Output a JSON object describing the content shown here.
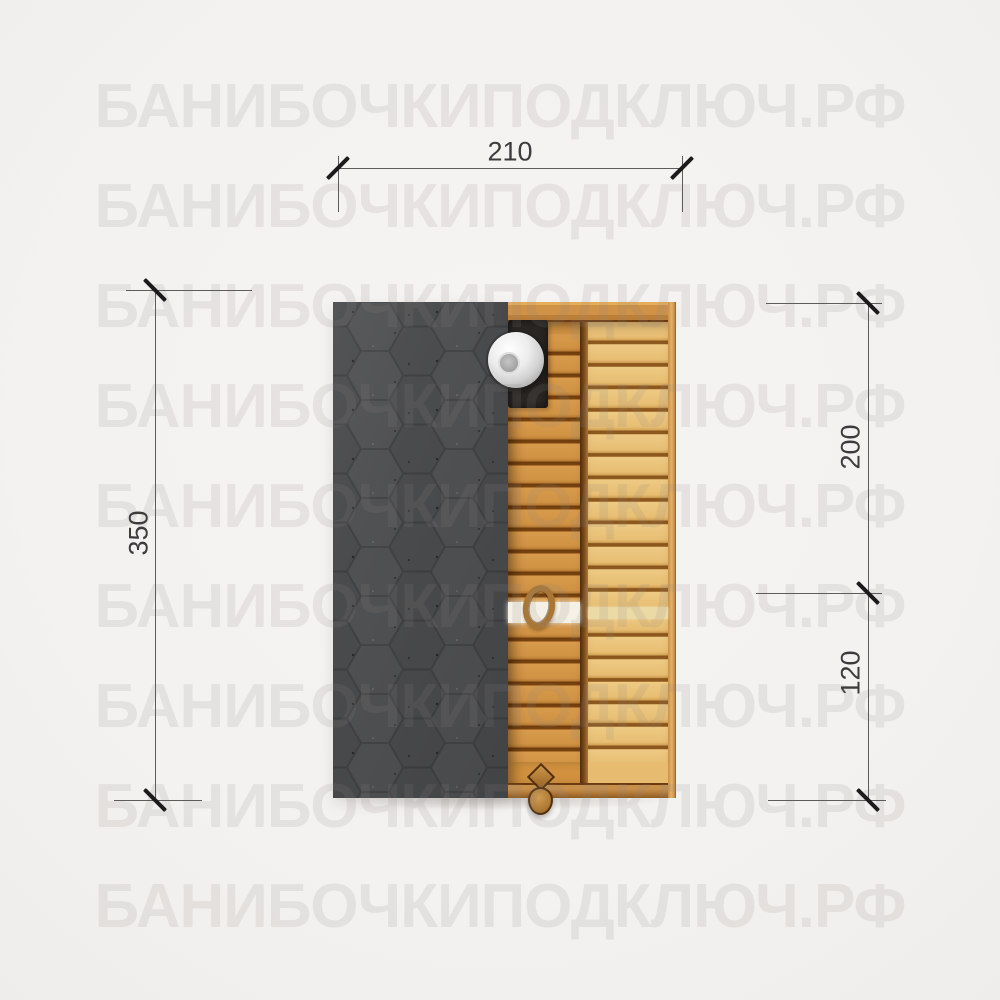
{
  "watermark": {
    "text": "БАНИБОЧКИПОДКЛЮЧ.РФ",
    "row_count": 9
  },
  "dimensions": {
    "top_width": {
      "label": "210"
    },
    "left_height": {
      "label": "350"
    },
    "right_upper": {
      "label": "200"
    },
    "right_lower": {
      "label": "120"
    }
  },
  "icons": {
    "chimney_cap": "round-metal-chimney-cap",
    "roof_texture": "hexagon-shingle-pattern"
  },
  "colors": {
    "background": "#f5f3f1",
    "roof": "#4a4b4d",
    "wood_left_plank": "#d09243",
    "wood_right_plank": "#e7be73",
    "dimension_line": "#5c5c5c",
    "tick": "#1b1b1b",
    "watermark": "rgba(140,136,132,0.15)"
  }
}
